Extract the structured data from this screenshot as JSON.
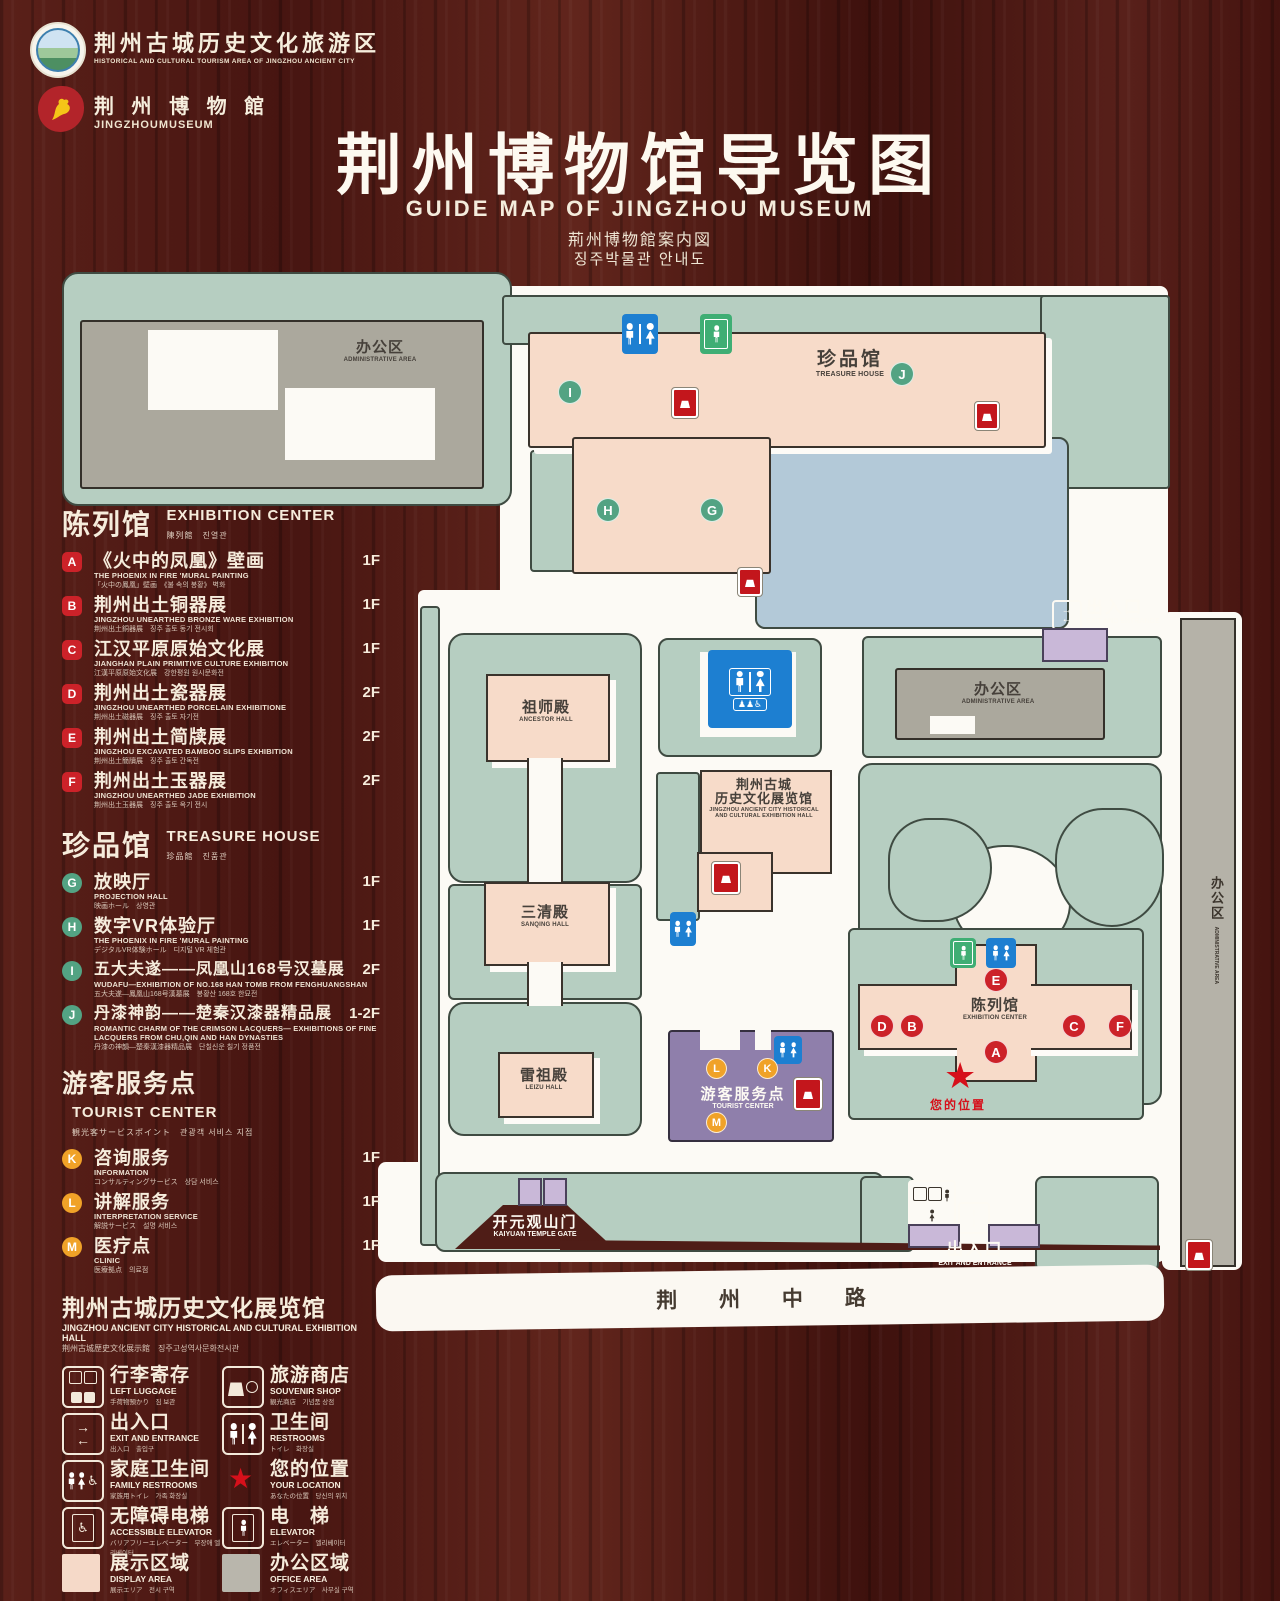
{
  "header": {
    "logo1_cn": "荆州古城历史文化旅游区",
    "logo1_en": "HISTORICAL AND CULTURAL TOURISM AREA OF JINGZHOU ANCIENT CITY",
    "logo2_cn": "荆 州 博 物 館",
    "logo2_en": "JINGZHOUMUSEUM",
    "title": "荆州博物馆导览图",
    "subtitle_en": "GUIDE MAP OF JINGZHOU MUSEUM",
    "subtitle_ja": "荊州博物館案内図",
    "subtitle_ko": "징주박물관 안내도"
  },
  "legend": {
    "sections": [
      {
        "title_cn": "陈列馆",
        "title_en": "EXHIBITION CENTER",
        "title_sub": "陳列館　진열관",
        "items": [
          {
            "letter": "A",
            "cn": "《火中的凤凰》壁画",
            "en": "THE PHOENIX IN FIRE 'MURAL PAINTING",
            "sub": "「火中の鳳凰」壁画　《불 속의 봉황》 벽화",
            "floor": "1F"
          },
          {
            "letter": "B",
            "cn": "荆州出土铜器展",
            "en": "JINGZHOU UNEARTHED BRONZE WARE EXHIBITION",
            "sub": "荆州出土銅器展　징주 출토 동기 전시회",
            "floor": "1F"
          },
          {
            "letter": "C",
            "cn": "江汉平原原始文化展",
            "en": "JIANGHAN PLAIN PRIMITIVE CULTURE EXHIBITION",
            "sub": "江漢平原原始文化展　강한평원 원시문화전",
            "floor": "1F"
          },
          {
            "letter": "D",
            "cn": "荆州出土瓷器展",
            "en": "JINGZHOU UNEARTHED PORCELAIN EXHIBITIONE",
            "sub": "荆州出土磁器展　징주 출토 자기전",
            "floor": "2F"
          },
          {
            "letter": "E",
            "cn": "荆州出土简牍展",
            "en": "JINGZHOU EXCAVATED BAMBOO SLIPS EXHIBITION",
            "sub": "荆州出土簡牘展　징주 출토 간독전",
            "floor": "2F"
          },
          {
            "letter": "F",
            "cn": "荆州出土玉器展",
            "en": "JINGZHOU UNEARTHED JADE EXHIBITION",
            "sub": "荆州出土玉器展　징주 출토 옥기 전시",
            "floor": "2F"
          }
        ]
      },
      {
        "title_cn": "珍品馆",
        "title_en": "TREASURE HOUSE",
        "title_sub": "珍品館　진품관",
        "items": [
          {
            "letter": "G",
            "cn": "放映厅",
            "en": "PROJECTION HALL",
            "sub": "映画ホール　상영관",
            "floor": "1F"
          },
          {
            "letter": "H",
            "cn": "数字VR体验厅",
            "en": "THE PHOENIX IN FIRE 'MURAL PAINTING",
            "sub": "デジタルVR体験ホール　디지털 VR 체험관",
            "floor": "1F"
          },
          {
            "letter": "I",
            "cn": "五大夫遂——凤凰山168号汉墓展",
            "en": "WUDAFU—EXHIBITION OF NO.168 HAN TOMB FROM FENGHUANGSHAN",
            "sub": "五大夫遂—鳳凰山168号漢墓展　봉황산 168호 한묘전",
            "floor": "2F"
          },
          {
            "letter": "J",
            "cn": "丹漆神韵——楚秦汉漆器精品展",
            "en": "ROMANTIC CHARM OF THE CRIMSON LACQUERS— EXHIBITIONS OF FINE LACQUERS FROM CHU,QIN AND HAN DYNASTIES",
            "sub": "丹漆の神韻—楚秦漢漆器精品展　단칠신운 칠기 정품전",
            "floor": "1-2F"
          }
        ]
      },
      {
        "title_cn": "游客服务点",
        "title_en": "TOURIST CENTER",
        "title_sub": "観光客サービスポイント　관광객 서비스 지점",
        "items": [
          {
            "letter": "K",
            "cn": "咨询服务",
            "en": "INFORMATION",
            "sub": "コンサルティングサービス　상담 서비스",
            "floor": "1F"
          },
          {
            "letter": "L",
            "cn": "讲解服务",
            "en": "INTERPRETATION SERVICE",
            "sub": "解説サービス　설명 서비스",
            "floor": "1F"
          },
          {
            "letter": "M",
            "cn": "医疗点",
            "en": "CLINIC",
            "sub": "医療拠点　의료점",
            "floor": "1F"
          }
        ]
      }
    ],
    "hall_title": {
      "cn": "荆州古城历史文化展览馆",
      "en": "JINGZHOU ANCIENT CITY HISTORICAL AND CULTURAL EXHIBITION HALL",
      "sub": "荆州古城歴史文化展示館　징주고성역사문화전시관"
    },
    "icons": [
      {
        "cn": "行李寄存",
        "en": "LEFT LUGGAGE",
        "sub": "手荷物預かり　짐 보관"
      },
      {
        "cn": "旅游商店",
        "en": "SOUVENIR SHOP",
        "sub": "観光商店　기념품 상점"
      },
      {
        "cn": "出入口",
        "en": "EXIT AND ENTRANCE",
        "sub": "出入口　출입구"
      },
      {
        "cn": "卫生间",
        "en": "RESTROOMS",
        "sub": "トイレ　화장실"
      },
      {
        "cn": "家庭卫生间",
        "en": "FAMILY RESTROOMS",
        "sub": "家族用トイレ　가족 화장실"
      },
      {
        "cn": "您的位置",
        "en": "YOUR LOCATION",
        "sub": "あなたの位置　당신의 위치"
      },
      {
        "cn": "无障碍电梯",
        "en": "ACCESSIBLE ELEVATOR",
        "sub": "バリアフリーエレベーター　무장애 엘리베이터"
      },
      {
        "cn": "电　梯",
        "en": "ELEVATOR",
        "sub": "エレベーター　엘리베이터"
      },
      {
        "cn": "展示区域",
        "en": "DISPLAY AREA",
        "sub": "展示エリア　전시 구역"
      },
      {
        "cn": "办公区域",
        "en": "OFFICE AREA",
        "sub": "オフィスエリア　사무실 구역"
      }
    ],
    "swatch_colors": {
      "display_area": "#f5d9c8",
      "office_area": "#b9b6ac"
    }
  },
  "map": {
    "admin_tl_cn": "办公区",
    "admin_tl_en": "ADMINISTRATIVE AREA",
    "treasure_cn": "珍品馆",
    "treasure_en": "TREASURE HOUSE",
    "exit_right_cn": "出入口",
    "exit_right_en": "EXIT AND ENTRANCE",
    "admin_r_cn": "办公区",
    "admin_r_en": "ADMINISTRATIVE AREA",
    "admin_strip_cn": "办公区",
    "admin_strip_en": "ADMINISTRATIVE AREA",
    "ancestor_cn": "祖师殿",
    "ancestor_en": "ANCESTOR HALL",
    "ancient1": "荆州古城",
    "ancient2": "历史文化展览馆",
    "ancient_en1": "JINGZHOU ANCIENT CITY HISTORICAL",
    "ancient_en2": "AND CULTURAL EXHIBITION HALL",
    "sanqing_cn": "三清殿",
    "sanqing_en": "SANQING HALL",
    "leizu_cn": "雷祖殿",
    "leizu_en": "LEIZU HALL",
    "tourist_cn": "游客服务点",
    "tourist_en": "TOURIST CENTER",
    "exhibition_cn": "陈列馆",
    "exhibition_en": "EXHIBITION CENTER",
    "your_location": "您的位置",
    "gate_cn": "开元观山门",
    "gate_en": "KAIYUAN TEMPLE GATE",
    "exit_bottom_cn": "出入口",
    "exit_bottom_en": "EXIT AND ENTRANCE",
    "road": "荆 州 中 路",
    "letters": {
      "a": "A",
      "b": "B",
      "c": "C",
      "d": "D",
      "e": "E",
      "f": "F",
      "g": "G",
      "h": "H",
      "i": "I",
      "j": "J",
      "k": "K",
      "l": "L",
      "m": "M"
    }
  }
}
